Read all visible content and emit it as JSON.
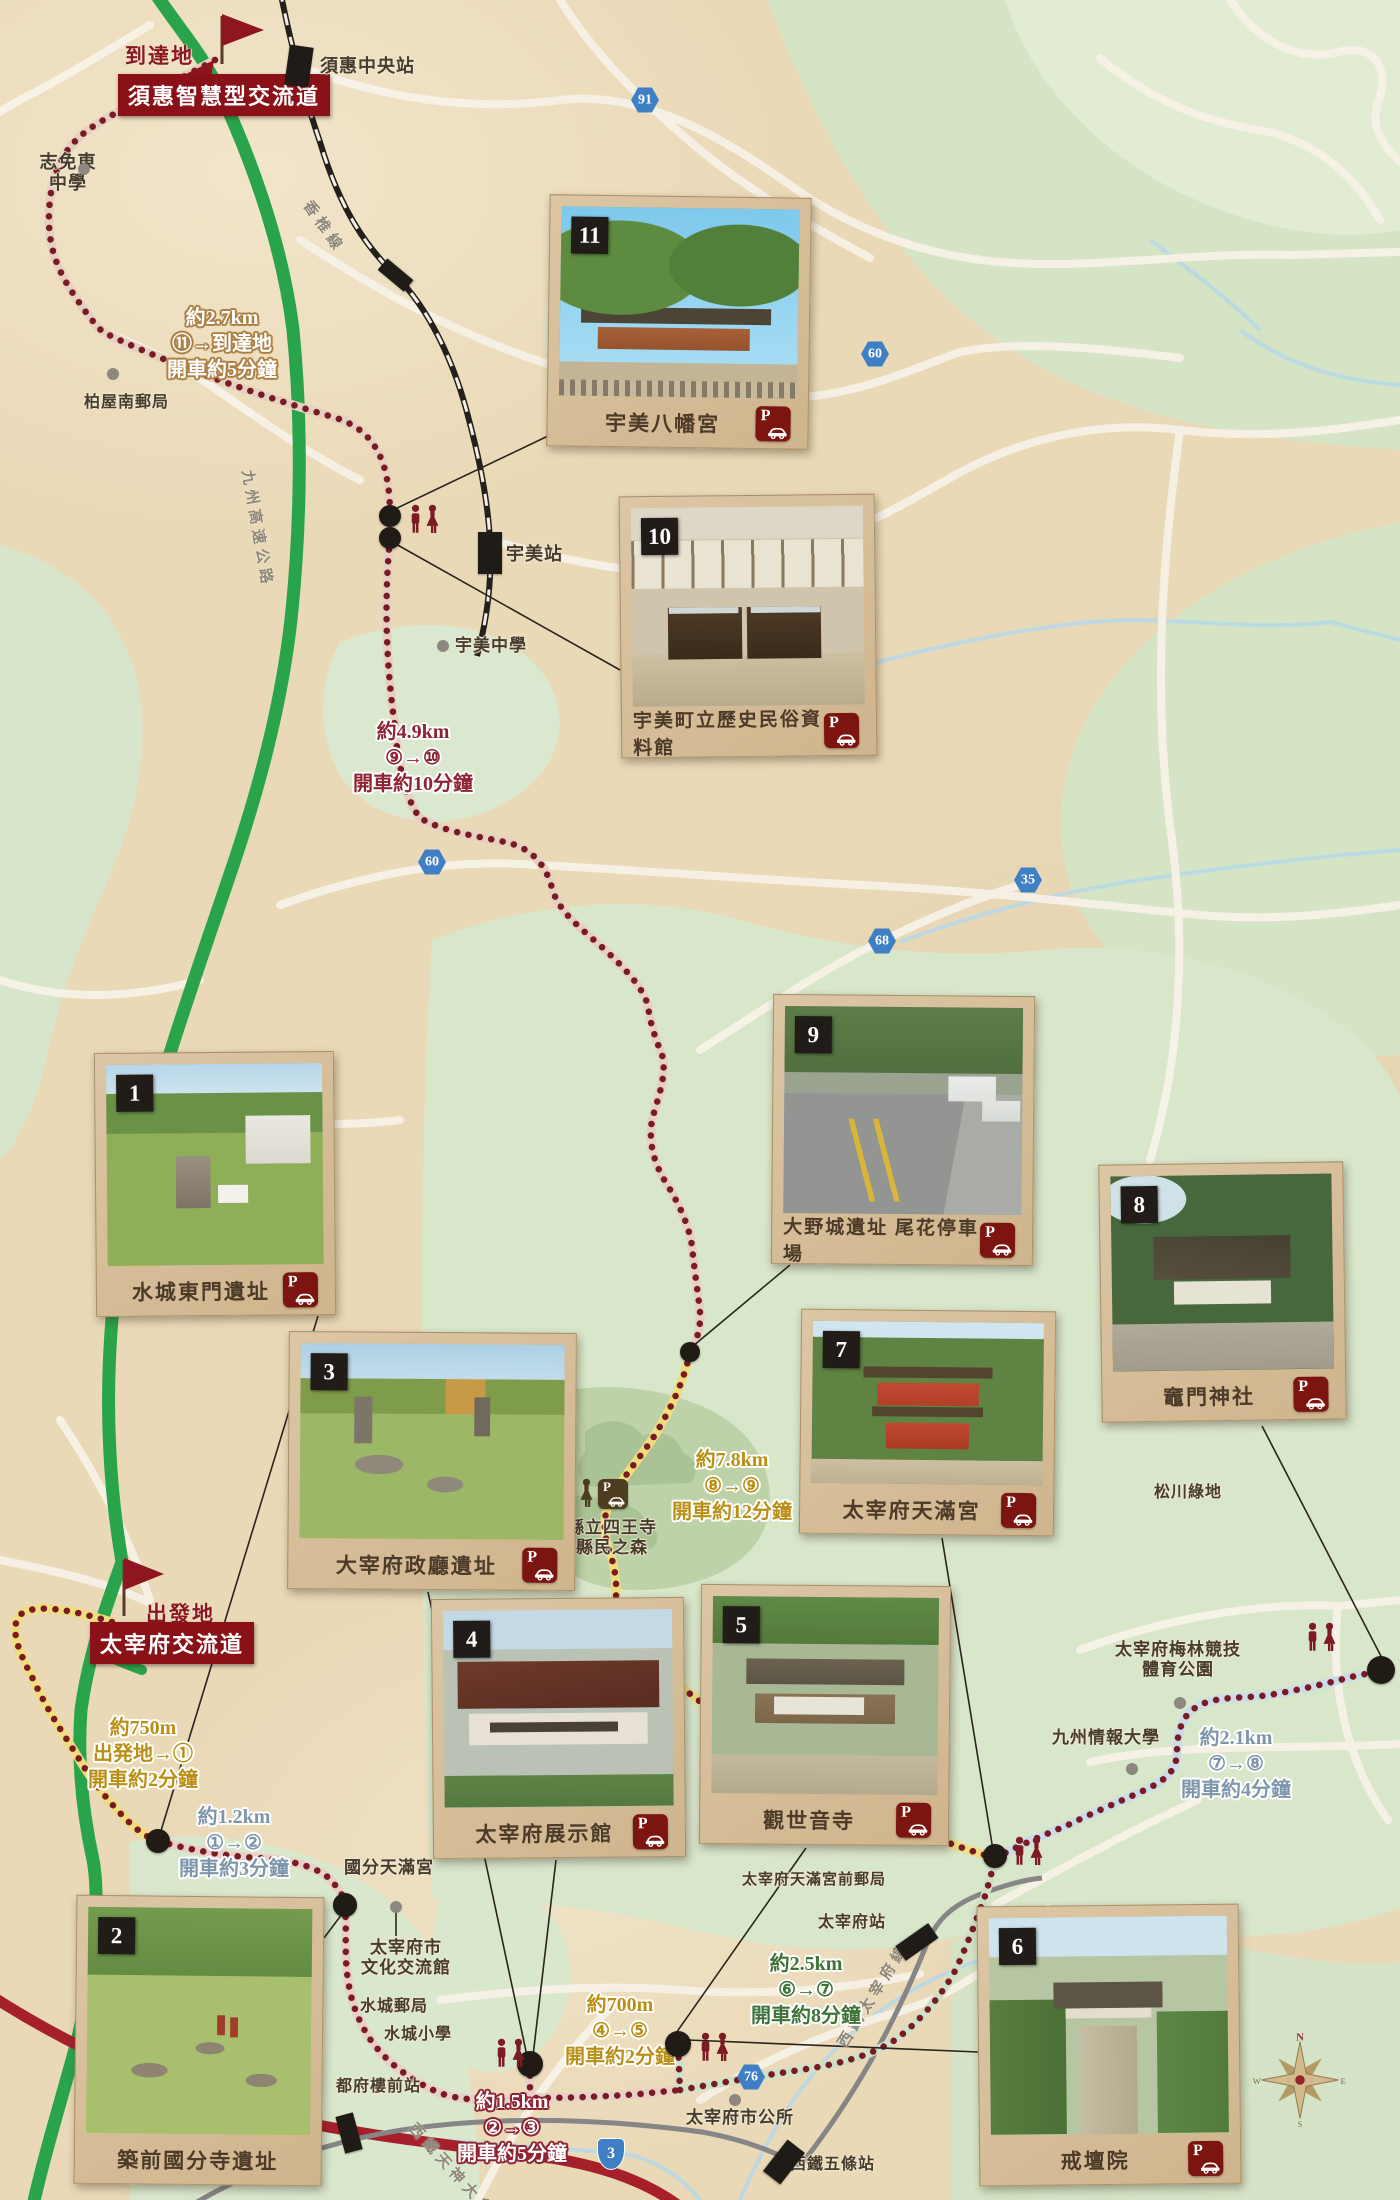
{
  "destination": {
    "label": "到達地",
    "interchange": "須惠智慧型交流道"
  },
  "start": {
    "label": "出發地",
    "interchange": "太宰府交流道"
  },
  "cards": [
    {
      "num": "1",
      "title": "水城東門遺址",
      "parking": true,
      "x": 95,
      "y": 1052,
      "w": 240,
      "h": 264,
      "rot": -0.5,
      "ph": "mizuki"
    },
    {
      "num": "2",
      "title": "築前國分寺遺址",
      "parking": false,
      "x": 75,
      "y": 1896,
      "w": 248,
      "h": 289,
      "rot": 0.6,
      "ph": "kokubunji"
    },
    {
      "num": "3",
      "title": "大宰府政廳遺址",
      "parking": true,
      "x": 288,
      "y": 1332,
      "w": 288,
      "h": 258,
      "rot": 0.4,
      "ph": "seicho"
    },
    {
      "num": "4",
      "title": "太宰府展示館",
      "parking": true,
      "x": 432,
      "y": 1598,
      "w": 253,
      "h": 260,
      "rot": -0.5,
      "ph": "tenjikan"
    },
    {
      "num": "5",
      "title": "觀世音寺",
      "parking": true,
      "x": 700,
      "y": 1585,
      "w": 250,
      "h": 260,
      "rot": 0.5,
      "ph": "kanzeonji"
    },
    {
      "num": "6",
      "title": "戒壇院",
      "parking": true,
      "x": 978,
      "y": 1905,
      "w": 262,
      "h": 280,
      "rot": -0.6,
      "ph": "kaidanin"
    },
    {
      "num": "7",
      "title": "太宰府天滿宮",
      "parking": true,
      "x": 800,
      "y": 1310,
      "w": 255,
      "h": 225,
      "rot": 0.6,
      "ph": "tenmangu"
    },
    {
      "num": "8",
      "title": "竈門神社",
      "parking": true,
      "x": 1100,
      "y": 1163,
      "w": 245,
      "h": 258,
      "rot": -0.8,
      "ph": "kamado"
    },
    {
      "num": "9",
      "title": "大野城遺址 尾花停車場",
      "parking": true,
      "x": 772,
      "y": 995,
      "w": 262,
      "h": 270,
      "rot": 0.5,
      "ph": "onojo"
    },
    {
      "num": "10",
      "title": "宇美町立歷史民俗資料館",
      "parking": true,
      "x": 620,
      "y": 495,
      "w": 256,
      "h": 262,
      "rot": -0.6,
      "ph": "museum"
    },
    {
      "num": "11",
      "title": "宇美八幡宮",
      "parking": true,
      "x": 548,
      "y": 196,
      "w": 262,
      "h": 252,
      "rot": 0.8,
      "ph": "umi"
    }
  ],
  "route_notes": [
    {
      "lines": [
        "約2.7km",
        "⑪→到達地",
        "開車約5分鐘"
      ],
      "x": 222,
      "y": 344,
      "style": "whitebrown"
    },
    {
      "lines": [
        "約4.9km",
        "⑨→⑩",
        "開車約10分鐘"
      ],
      "x": 413,
      "y": 758,
      "style": "red"
    },
    {
      "lines": [
        "約7.8km",
        "⑧→⑨",
        "開車約12分鐘"
      ],
      "x": 732,
      "y": 1486,
      "style": "gold"
    },
    {
      "lines": [
        "約750m",
        "出発地→①",
        "開車約2分鐘"
      ],
      "x": 143,
      "y": 1754,
      "style": "gold"
    },
    {
      "lines": [
        "約1.2km",
        "①→②",
        "開車約3分鐘"
      ],
      "x": 234,
      "y": 1843,
      "style": "slate"
    },
    {
      "lines": [
        "約2.1km",
        "⑦→⑧",
        "開車約4分鐘"
      ],
      "x": 1236,
      "y": 1764,
      "style": "slate"
    },
    {
      "lines": [
        "約2.5km",
        "⑥→⑦",
        "開車約8分鐘"
      ],
      "x": 806,
      "y": 1990,
      "style": "green"
    },
    {
      "lines": [
        "約700m",
        "④→⑤",
        "開車約2分鐘"
      ],
      "x": 620,
      "y": 2031,
      "style": "gold"
    },
    {
      "lines": [
        "約1.5km",
        "②→③",
        "開車約5分鐘"
      ],
      "x": 512,
      "y": 2128,
      "style": "whitemaroon"
    }
  ],
  "pois": [
    {
      "t": "須惠中央站",
      "x": 320,
      "y": 56,
      "size": 18
    },
    {
      "t": "志免東\n中學",
      "x": 28,
      "y": 152,
      "size": 18,
      "w": 80,
      "dot": [
        84,
        169
      ]
    },
    {
      "t": "柏屋南郵局",
      "x": 84,
      "y": 394,
      "size": 16,
      "dot": [
        113,
        374
      ]
    },
    {
      "t": "宇美站",
      "x": 506,
      "y": 544,
      "size": 18
    },
    {
      "t": "宇美中學",
      "x": 455,
      "y": 636,
      "size": 17,
      "dot": [
        443,
        646
      ]
    },
    {
      "t": "縣立四王寺\n縣民之森",
      "x": 556,
      "y": 1518,
      "size": 17,
      "w": 112
    },
    {
      "t": "松川綠地",
      "x": 1154,
      "y": 1484,
      "size": 16
    },
    {
      "t": "太宰府梅林競技\n體育公園",
      "x": 1108,
      "y": 1640,
      "size": 17,
      "w": 140,
      "dot": [
        1180,
        1703
      ]
    },
    {
      "t": "九州情報大學",
      "x": 1052,
      "y": 1728,
      "size": 17,
      "dot": [
        1132,
        1769
      ]
    },
    {
      "t": "國分天滿宮",
      "x": 344,
      "y": 1858,
      "size": 17
    },
    {
      "t": "太宰府市\n文化交流館",
      "x": 356,
      "y": 1938,
      "size": 17,
      "w": 100,
      "dot": [
        396,
        1907
      ]
    },
    {
      "t": "水城郵局",
      "x": 360,
      "y": 1998,
      "size": 16
    },
    {
      "t": "水城小學",
      "x": 384,
      "y": 2026,
      "size": 16
    },
    {
      "t": "都府樓前站",
      "x": 336,
      "y": 2078,
      "size": 16
    },
    {
      "t": "太宰府天滿宮前郵局",
      "x": 742,
      "y": 1872,
      "size": 15
    },
    {
      "t": "太宰府站",
      "x": 818,
      "y": 1914,
      "size": 16
    },
    {
      "t": "太宰府市公所",
      "x": 686,
      "y": 2108,
      "size": 17,
      "dot": [
        735,
        2100
      ]
    },
    {
      "t": "西鐵五條站",
      "x": 790,
      "y": 2156,
      "size": 16
    }
  ],
  "rail_labels": [
    {
      "t": "香椎線",
      "x": 316,
      "y": 196,
      "rot": 55
    },
    {
      "t": "九州高速公路",
      "x": 258,
      "y": 468,
      "rot": 80
    },
    {
      "t": "西鐵天神大牟田線",
      "x": 420,
      "y": 2118,
      "rot": 48
    },
    {
      "t": "西鐵太宰府線",
      "x": 832,
      "y": 2040,
      "rot": -58
    }
  ],
  "road_badges": [
    {
      "n": "91",
      "x": 645,
      "y": 100
    },
    {
      "n": "60",
      "x": 875,
      "y": 354
    },
    {
      "n": "60",
      "x": 432,
      "y": 862
    },
    {
      "n": "35",
      "x": 1028,
      "y": 880
    },
    {
      "n": "68",
      "x": 882,
      "y": 941
    },
    {
      "n": "76",
      "x": 751,
      "y": 2077
    },
    {
      "n": "3",
      "x": 611,
      "y": 2154,
      "shield": true
    }
  ],
  "spots": [
    [
      390,
      516,
      11
    ],
    [
      390,
      538,
      11
    ],
    [
      690,
      1352,
      10
    ],
    [
      158,
      1841,
      12
    ],
    [
      345,
      1905,
      12
    ],
    [
      530,
      2064,
      13
    ],
    [
      678,
      2044,
      13
    ],
    [
      995,
      1856,
      12
    ],
    [
      1381,
      1670,
      14
    ]
  ],
  "restrooms": [
    {
      "x": 406,
      "y": 504,
      "c": "#7c1b24"
    },
    {
      "x": 560,
      "y": 1478,
      "c": "#4e3e20",
      "p": true
    },
    {
      "x": 1303,
      "y": 1622,
      "c": "#7c1b24"
    },
    {
      "x": 1010,
      "y": 1836,
      "c": "#7c1b24"
    },
    {
      "x": 492,
      "y": 2038,
      "c": "#7c1b24"
    },
    {
      "x": 696,
      "y": 2032,
      "c": "#7c1b24"
    }
  ],
  "stations": [
    {
      "x": 287,
      "y": 46,
      "w": 24,
      "h": 40,
      "r": 8
    },
    {
      "x": 388,
      "y": 258,
      "w": 15,
      "h": 34,
      "r": -50
    },
    {
      "x": 478,
      "y": 532,
      "w": 24,
      "h": 42,
      "r": 0
    },
    {
      "x": 340,
      "y": 2114,
      "w": 18,
      "h": 38,
      "r": -15
    },
    {
      "x": 773,
      "y": 2142,
      "w": 22,
      "h": 40,
      "r": 38
    },
    {
      "x": 908,
      "y": 1922,
      "w": 18,
      "h": 40,
      "r": 55
    }
  ],
  "compass": {
    "n": "N",
    "e": "E",
    "s": "S",
    "w": "W"
  },
  "icons": {
    "parking": "parking-car-badge",
    "restroom": "male-female-figures",
    "spot": "black-dot",
    "poi": "gray-dot"
  },
  "colors": {
    "route_dot": "#7a1b24",
    "expressway": "#2aa44b",
    "national_road": "#a6202c",
    "label_box": "#8a1118",
    "parking_badge": "#7c150f",
    "road_badge": "#3f80c4"
  }
}
